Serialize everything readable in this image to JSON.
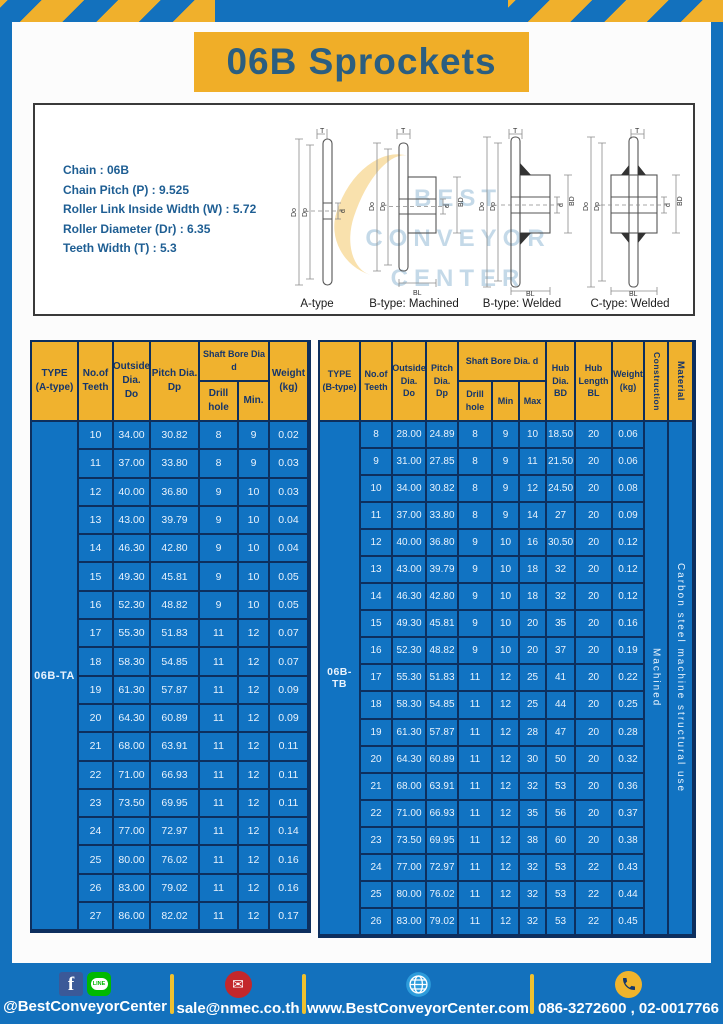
{
  "header": {
    "title": "06B Sprockets"
  },
  "specs": {
    "lines": [
      "Chain  : 06B",
      "Chain Pitch (P)  :  9.525",
      "Roller Link Inside Width (W)  :  5.72",
      "Roller Diameter (Dr)  : 6.35",
      "Teeth Width (T)  :  5.3"
    ]
  },
  "diagrams": {
    "labels": [
      "A-type",
      "B-type: Machined",
      "B-type: Welded",
      "C-type: Welded"
    ],
    "dims": {
      "T": "T",
      "Do": "Do",
      "Dp": "Dp",
      "d": "d",
      "BD": "BD",
      "BL": "BL"
    },
    "watermark": [
      "BEST",
      "CONVEYOR",
      "CENTER"
    ]
  },
  "table_a": {
    "headers": {
      "type": "TYPE\n(A-type)",
      "teeth": "No.of\nTeeth",
      "outside": "Outside\nDia.\nDo",
      "pitch": "Pitch Dia.\nDp",
      "shaft_bore": "Shaft Bore Dia d",
      "drill": "Drill hole",
      "min": "Min.",
      "weight": "Weight\n(kg)"
    },
    "type_label": "06B-TA",
    "rows": [
      [
        "10",
        "34.00",
        "30.82",
        "8",
        "9",
        "0.02"
      ],
      [
        "11",
        "37.00",
        "33.80",
        "8",
        "9",
        "0.03"
      ],
      [
        "12",
        "40.00",
        "36.80",
        "9",
        "10",
        "0.03"
      ],
      [
        "13",
        "43.00",
        "39.79",
        "9",
        "10",
        "0.04"
      ],
      [
        "14",
        "46.30",
        "42.80",
        "9",
        "10",
        "0.04"
      ],
      [
        "15",
        "49.30",
        "45.81",
        "9",
        "10",
        "0.05"
      ],
      [
        "16",
        "52.30",
        "48.82",
        "9",
        "10",
        "0.05"
      ],
      [
        "17",
        "55.30",
        "51.83",
        "11",
        "12",
        "0.07"
      ],
      [
        "18",
        "58.30",
        "54.85",
        "11",
        "12",
        "0.07"
      ],
      [
        "19",
        "61.30",
        "57.87",
        "11",
        "12",
        "0.09"
      ],
      [
        "20",
        "64.30",
        "60.89",
        "11",
        "12",
        "0.09"
      ],
      [
        "21",
        "68.00",
        "63.91",
        "11",
        "12",
        "0.11"
      ],
      [
        "22",
        "71.00",
        "66.93",
        "11",
        "12",
        "0.11"
      ],
      [
        "23",
        "73.50",
        "69.95",
        "11",
        "12",
        "0.11"
      ],
      [
        "24",
        "77.00",
        "72.97",
        "11",
        "12",
        "0.14"
      ],
      [
        "25",
        "80.00",
        "76.02",
        "11",
        "12",
        "0.16"
      ],
      [
        "26",
        "83.00",
        "79.02",
        "11",
        "12",
        "0.16"
      ],
      [
        "27",
        "86.00",
        "82.02",
        "11",
        "12",
        "0.17"
      ]
    ]
  },
  "table_b": {
    "headers": {
      "type": "TYPE\n(B-type)",
      "teeth": "No.of\nTeeth",
      "outside": "Outside\nDia.\nDo",
      "pitch": "Pitch\nDia.\nDp",
      "shaft_bore": "Shaft Bore Dia. d",
      "drill": "Drill hole",
      "min": "Min",
      "max": "Max",
      "hub_dia": "Hub\nDia.\nBD",
      "hub_len": "Hub\nLength\nBL",
      "weight": "Weight\n(kg)",
      "construction": "Construction",
      "material": "Material"
    },
    "type_label": "06B-TB",
    "construction_value": "Machined",
    "material_value": "Carbon steel machine structural use",
    "rows": [
      [
        "8",
        "28.00",
        "24.89",
        "8",
        "9",
        "10",
        "18.50",
        "20",
        "0.06"
      ],
      [
        "9",
        "31.00",
        "27.85",
        "8",
        "9",
        "11",
        "21.50",
        "20",
        "0.06"
      ],
      [
        "10",
        "34.00",
        "30.82",
        "8",
        "9",
        "12",
        "24.50",
        "20",
        "0.08"
      ],
      [
        "11",
        "37.00",
        "33.80",
        "8",
        "9",
        "14",
        "27",
        "20",
        "0.09"
      ],
      [
        "12",
        "40.00",
        "36.80",
        "9",
        "10",
        "16",
        "30.50",
        "20",
        "0.12"
      ],
      [
        "13",
        "43.00",
        "39.79",
        "9",
        "10",
        "18",
        "32",
        "20",
        "0.12"
      ],
      [
        "14",
        "46.30",
        "42.80",
        "9",
        "10",
        "18",
        "32",
        "20",
        "0.12"
      ],
      [
        "15",
        "49.30",
        "45.81",
        "9",
        "10",
        "20",
        "35",
        "20",
        "0.16"
      ],
      [
        "16",
        "52.30",
        "48.82",
        "9",
        "10",
        "20",
        "37",
        "20",
        "0.19"
      ],
      [
        "17",
        "55.30",
        "51.83",
        "11",
        "12",
        "25",
        "41",
        "20",
        "0.22"
      ],
      [
        "18",
        "58.30",
        "54.85",
        "11",
        "12",
        "25",
        "44",
        "20",
        "0.25"
      ],
      [
        "19",
        "61.30",
        "57.87",
        "11",
        "12",
        "28",
        "47",
        "20",
        "0.28"
      ],
      [
        "20",
        "64.30",
        "60.89",
        "11",
        "12",
        "30",
        "50",
        "20",
        "0.32"
      ],
      [
        "21",
        "68.00",
        "63.91",
        "11",
        "12",
        "32",
        "53",
        "20",
        "0.36"
      ],
      [
        "22",
        "71.00",
        "66.93",
        "11",
        "12",
        "35",
        "56",
        "20",
        "0.37"
      ],
      [
        "23",
        "73.50",
        "69.95",
        "11",
        "12",
        "38",
        "60",
        "20",
        "0.38"
      ],
      [
        "24",
        "77.00",
        "72.97",
        "11",
        "12",
        "32",
        "53",
        "22",
        "0.43"
      ],
      [
        "25",
        "80.00",
        "76.02",
        "11",
        "12",
        "32",
        "53",
        "22",
        "0.44"
      ],
      [
        "26",
        "83.00",
        "79.02",
        "11",
        "12",
        "32",
        "53",
        "22",
        "0.45"
      ]
    ]
  },
  "footer": {
    "social": "@BestConveyorCenter",
    "facebook_letter": "f",
    "line_label": "LINE",
    "email": "sale@nmec.co.th",
    "website": "www.BestConveyorCenter.com",
    "phones": "086-3272600 , 02-0017766",
    "mail_glyph": "✉"
  },
  "colors": {
    "page_blue": "#1371BD",
    "banner_yellow": "#F0AE28",
    "table_header_yellow": "#F0B22E",
    "table_body_blue": "#1173C2",
    "border_navy": "#0D2F5E",
    "title_text": "#2B5E80",
    "spec_text": "#1E5E93"
  }
}
